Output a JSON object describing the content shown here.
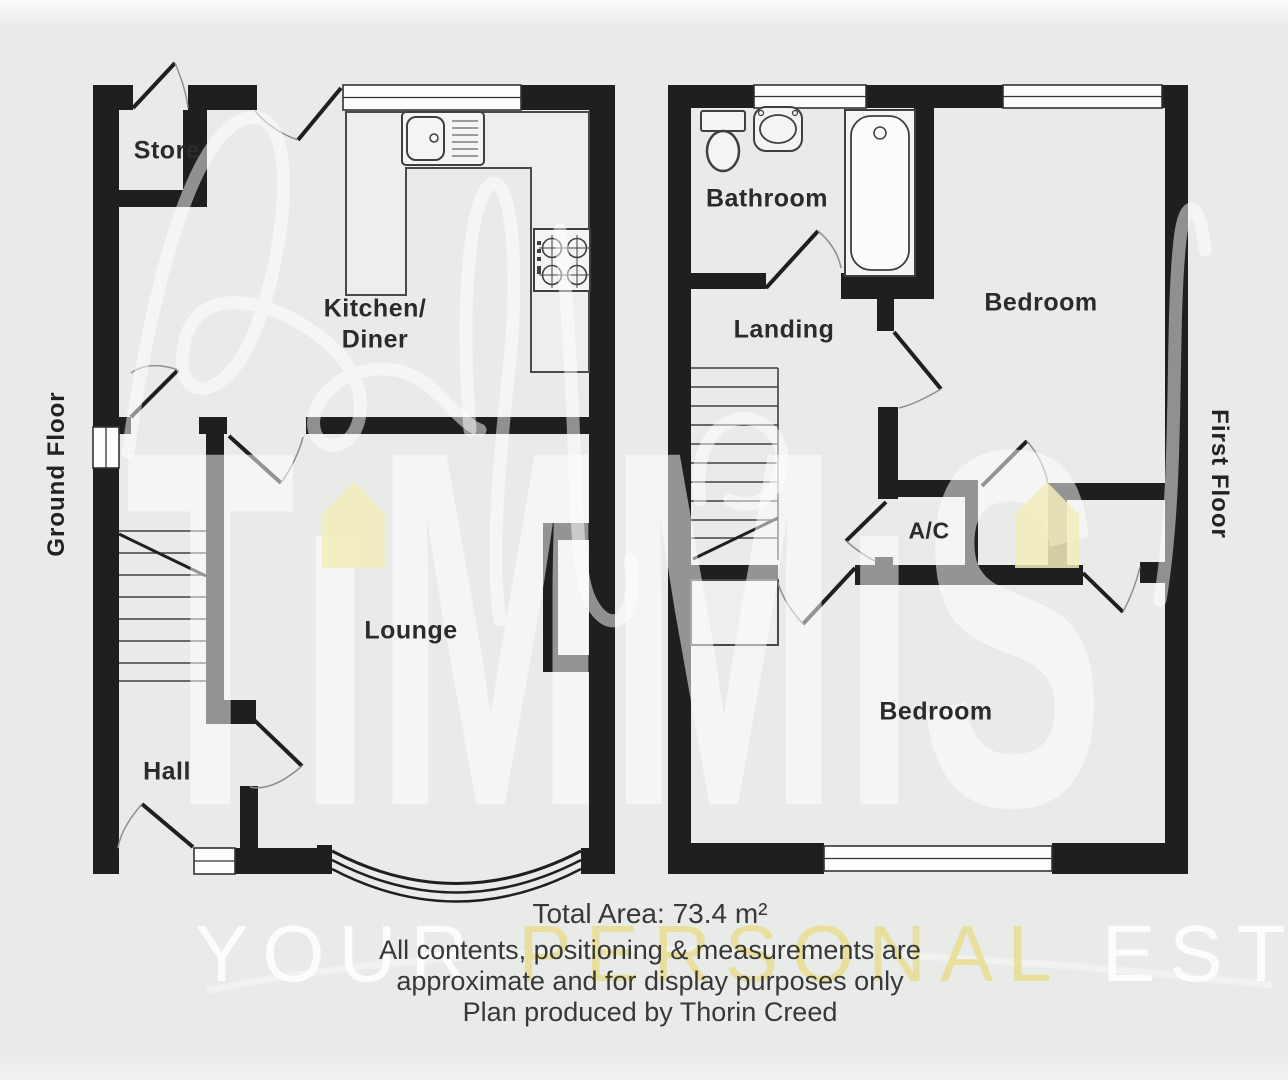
{
  "canvas": {
    "width": 1288,
    "height": 1080
  },
  "floors": {
    "ground": {
      "label": "Ground Floor",
      "rooms": {
        "store": "Store",
        "kitchen_line1": "Kitchen/",
        "kitchen_line2": "Diner",
        "lounge": "Lounge",
        "hall": "Hall"
      }
    },
    "first": {
      "label": "First Floor",
      "rooms": {
        "bathroom": "Bathroom",
        "landing": "Landing",
        "bedroom_top": "Bedroom",
        "airing_cupboard": "A/C",
        "bedroom_bottom": "Bedroom"
      }
    }
  },
  "footer": {
    "total_area": "Total Area: 73.4 m²",
    "disclaimer_line1": "All contents, positioning & measurements are",
    "disclaimer_line2": "approximate and for display purposes only",
    "produced_by": "Plan produced by Thorin Creed"
  },
  "watermark": {
    "brand": "TiMMiS",
    "brand_display": "TıMMıS",
    "tagline_word1": "YOUR",
    "tagline_word2": "PERSONAL",
    "tagline_word3": "ESTA",
    "house_icon_color": "#f2ecba"
  },
  "colors": {
    "wall": "#1f201e",
    "background": "#e9ebe8",
    "fixture_line": "#3f3f3f",
    "label_text": "#2b2b2b",
    "footer_text": "#383838"
  }
}
